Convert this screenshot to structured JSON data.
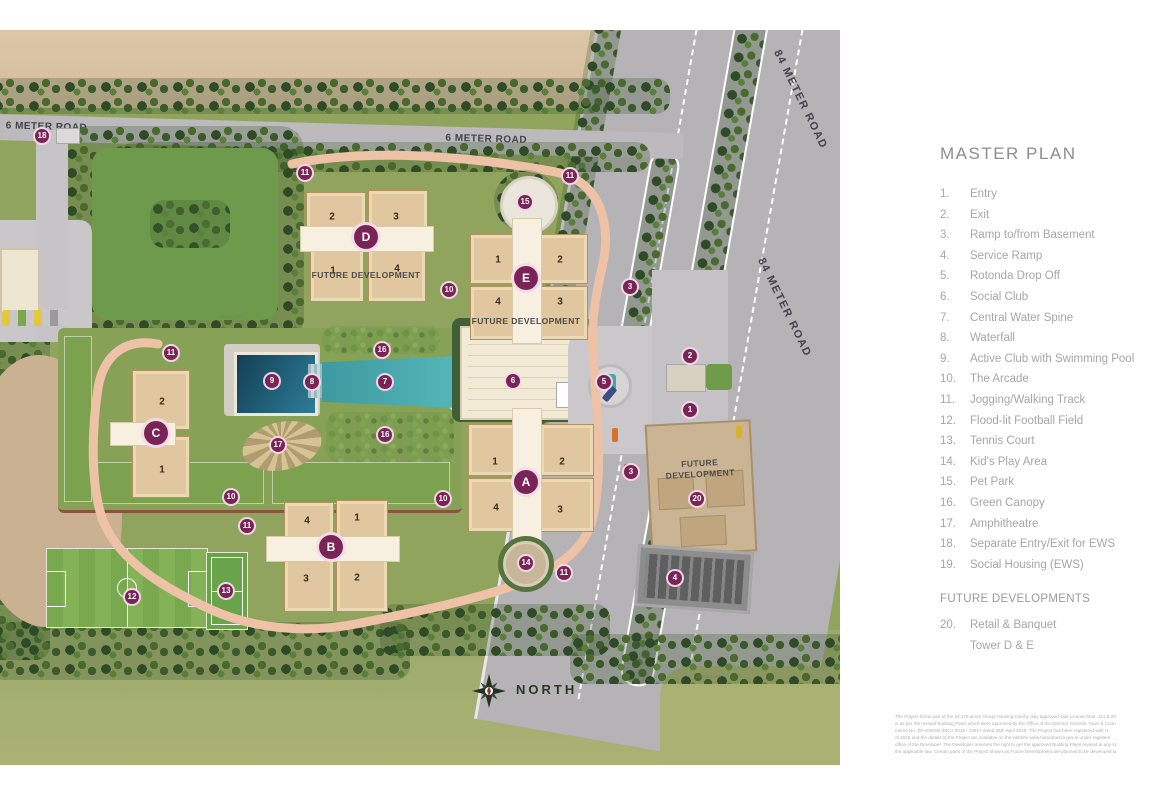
{
  "legend": {
    "title": "MASTER PLAN",
    "items": [
      {
        "num": "1.",
        "label": "Entry"
      },
      {
        "num": "2.",
        "label": "Exit"
      },
      {
        "num": "3.",
        "label": "Ramp to/from Basement"
      },
      {
        "num": "4.",
        "label": "Service Ramp"
      },
      {
        "num": "5.",
        "label": "Rotonda Drop Off"
      },
      {
        "num": "6.",
        "label": "Social Club"
      },
      {
        "num": "7.",
        "label": "Central Water Spine"
      },
      {
        "num": "8.",
        "label": "Waterfall"
      },
      {
        "num": "9.",
        "label": "Active Club with Swimming Pool"
      },
      {
        "num": "10.",
        "label": "The Arcade"
      },
      {
        "num": "11.",
        "label": "Jogging/Walking Track"
      },
      {
        "num": "12.",
        "label": "Flood-lit Football Field"
      },
      {
        "num": "13.",
        "label": "Tennis Court"
      },
      {
        "num": "14.",
        "label": "Kid's Play Area"
      },
      {
        "num": "15.",
        "label": "Pet Park"
      },
      {
        "num": "16.",
        "label": "Green Canopy"
      },
      {
        "num": "17.",
        "label": "Amphitheatre"
      },
      {
        "num": "18.",
        "label": "Separate Entry/Exit for EWS"
      },
      {
        "num": "19.",
        "label": "Social Housing (EWS)"
      }
    ],
    "future_header": "FUTURE DEVELOPMENTS",
    "future_items": [
      {
        "num": "20.",
        "label": "Retail & Banquet"
      },
      {
        "num": "",
        "label": "Tower D & E"
      }
    ],
    "disclaimer_lines": [
      "The Project forms part of the 24.175 acres Group Housing Colony duly approved vide License Nos. 114 & 20",
      "is as per the revised Building Plans which were approved by the Office of the Director General, Town & Coun",
      "memo No. ZP-409/SD (DK) / 2019 / 10517 dated 25th April 2019. The Project has been registered with H",
      "of 2019 and the details of the Project are available on the website www.haryanarera.gov.in under registere",
      "office of the Developer. The Developer reserves the right to get the approved Building Plans revised at any st",
      "the applicable law. Certain parts of the Project shown as Future Development are planned to be developed la"
    ]
  },
  "map": {
    "labels": {
      "six_meter_road_left": "6 METER ROAD",
      "six_meter_road_center": "6 METER ROAD",
      "eighty_four_meter_road_upper": "84 METER ROAD",
      "eighty_four_meter_road_lower": "84 METER ROAD",
      "north": "NORTH",
      "future_caption": "FUTURE DEVELOPMENT",
      "others_land": "Others Land"
    },
    "towers": [
      {
        "letter": "D",
        "units": [
          "2",
          "3",
          "1",
          "4"
        ]
      },
      {
        "letter": "E",
        "units": [
          "1",
          "2",
          "4",
          "3"
        ]
      },
      {
        "letter": "A",
        "units": [
          "1",
          "2",
          "4",
          "3"
        ]
      },
      {
        "letter": "B",
        "units": [
          "4",
          "1",
          "3",
          "2"
        ]
      },
      {
        "letter": "C",
        "units": [
          "2",
          "1"
        ]
      }
    ],
    "markers": [
      {
        "n": "18",
        "x": 42,
        "y": 106
      },
      {
        "n": "11",
        "x": 305,
        "y": 143
      },
      {
        "n": "11",
        "x": 570,
        "y": 146
      },
      {
        "n": "11",
        "x": 171,
        "y": 323
      },
      {
        "n": "11",
        "x": 247,
        "y": 496
      },
      {
        "n": "11",
        "x": 564,
        "y": 543
      },
      {
        "n": "15",
        "x": 525,
        "y": 172
      },
      {
        "n": "10",
        "x": 449,
        "y": 260
      },
      {
        "n": "10",
        "x": 231,
        "y": 467
      },
      {
        "n": "10",
        "x": 443,
        "y": 469
      },
      {
        "n": "9",
        "x": 272,
        "y": 351
      },
      {
        "n": "8",
        "x": 312,
        "y": 352
      },
      {
        "n": "7",
        "x": 385,
        "y": 352
      },
      {
        "n": "16",
        "x": 382,
        "y": 320
      },
      {
        "n": "16",
        "x": 385,
        "y": 405
      },
      {
        "n": "17",
        "x": 278,
        "y": 415
      },
      {
        "n": "6",
        "x": 513,
        "y": 351
      },
      {
        "n": "5",
        "x": 604,
        "y": 352
      },
      {
        "n": "3",
        "x": 630,
        "y": 257
      },
      {
        "n": "3",
        "x": 631,
        "y": 442
      },
      {
        "n": "2",
        "x": 690,
        "y": 326
      },
      {
        "n": "1",
        "x": 690,
        "y": 380
      },
      {
        "n": "20",
        "x": 697,
        "y": 469
      },
      {
        "n": "4",
        "x": 675,
        "y": 548
      },
      {
        "n": "12",
        "x": 132,
        "y": 567
      },
      {
        "n": "13",
        "x": 226,
        "y": 561
      },
      {
        "n": "14",
        "x": 526,
        "y": 533
      }
    ],
    "colors": {
      "marker": "#7a2356",
      "marker_ring": "#f3dbe8",
      "road": "#b5b3b5",
      "pool_water": "#2e7d98",
      "water_spine": "#4aa9ad",
      "grass": "#90a45e",
      "tree_dark": "#2e4a26",
      "building_cream": "#e0c79f",
      "track": "#edc2a6",
      "dirt": "#d8c2a4"
    }
  }
}
